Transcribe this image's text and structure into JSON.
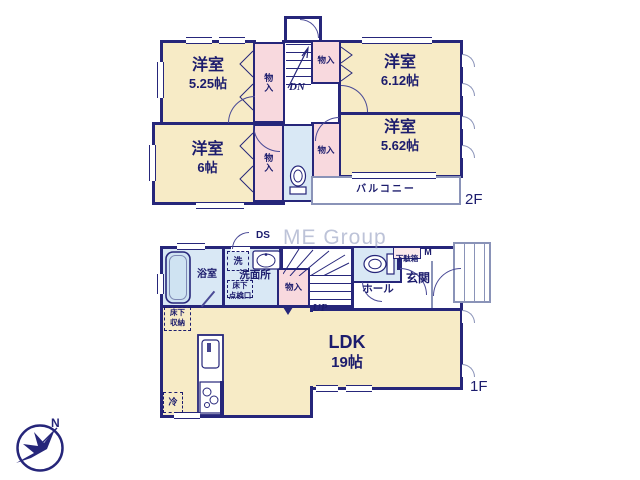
{
  "colors": {
    "wall": "#26267a",
    "room_fill": "#f7ebc6",
    "closet_fill": "#f8d9de",
    "wet_area_fill": "#d9e8f5",
    "text": "#1c1c6d"
  },
  "watermark": "ME Group",
  "compass": {
    "north": "N"
  },
  "floor2": {
    "floor_label": "2F",
    "rooms": [
      {
        "label": "洋室",
        "size": "5.25帖"
      },
      {
        "label": "洋室",
        "size": "6.12帖"
      },
      {
        "label": "洋室",
        "size": "6帖"
      },
      {
        "label": "洋室",
        "size": "5.62帖"
      }
    ],
    "closet": "物入",
    "stairs_down": "DN",
    "balcony": "バルコニー"
  },
  "floor1": {
    "floor_label": "1F",
    "ldk": {
      "label": "LDK",
      "size": "19帖"
    },
    "bathroom": "浴室",
    "washer": "洗",
    "washroom": "洗面所",
    "underfloor_access": [
      "床下",
      "点検口"
    ],
    "underfloor_storage": [
      "床下",
      "収納"
    ],
    "closet": "物入",
    "stairs_up": "UP",
    "duct_space": "DS",
    "hall": "ホール",
    "entrance": "玄関",
    "shoe_cabinet": "下駄箱",
    "shoe_cabinet_mark": "M",
    "fridge": "冷"
  }
}
